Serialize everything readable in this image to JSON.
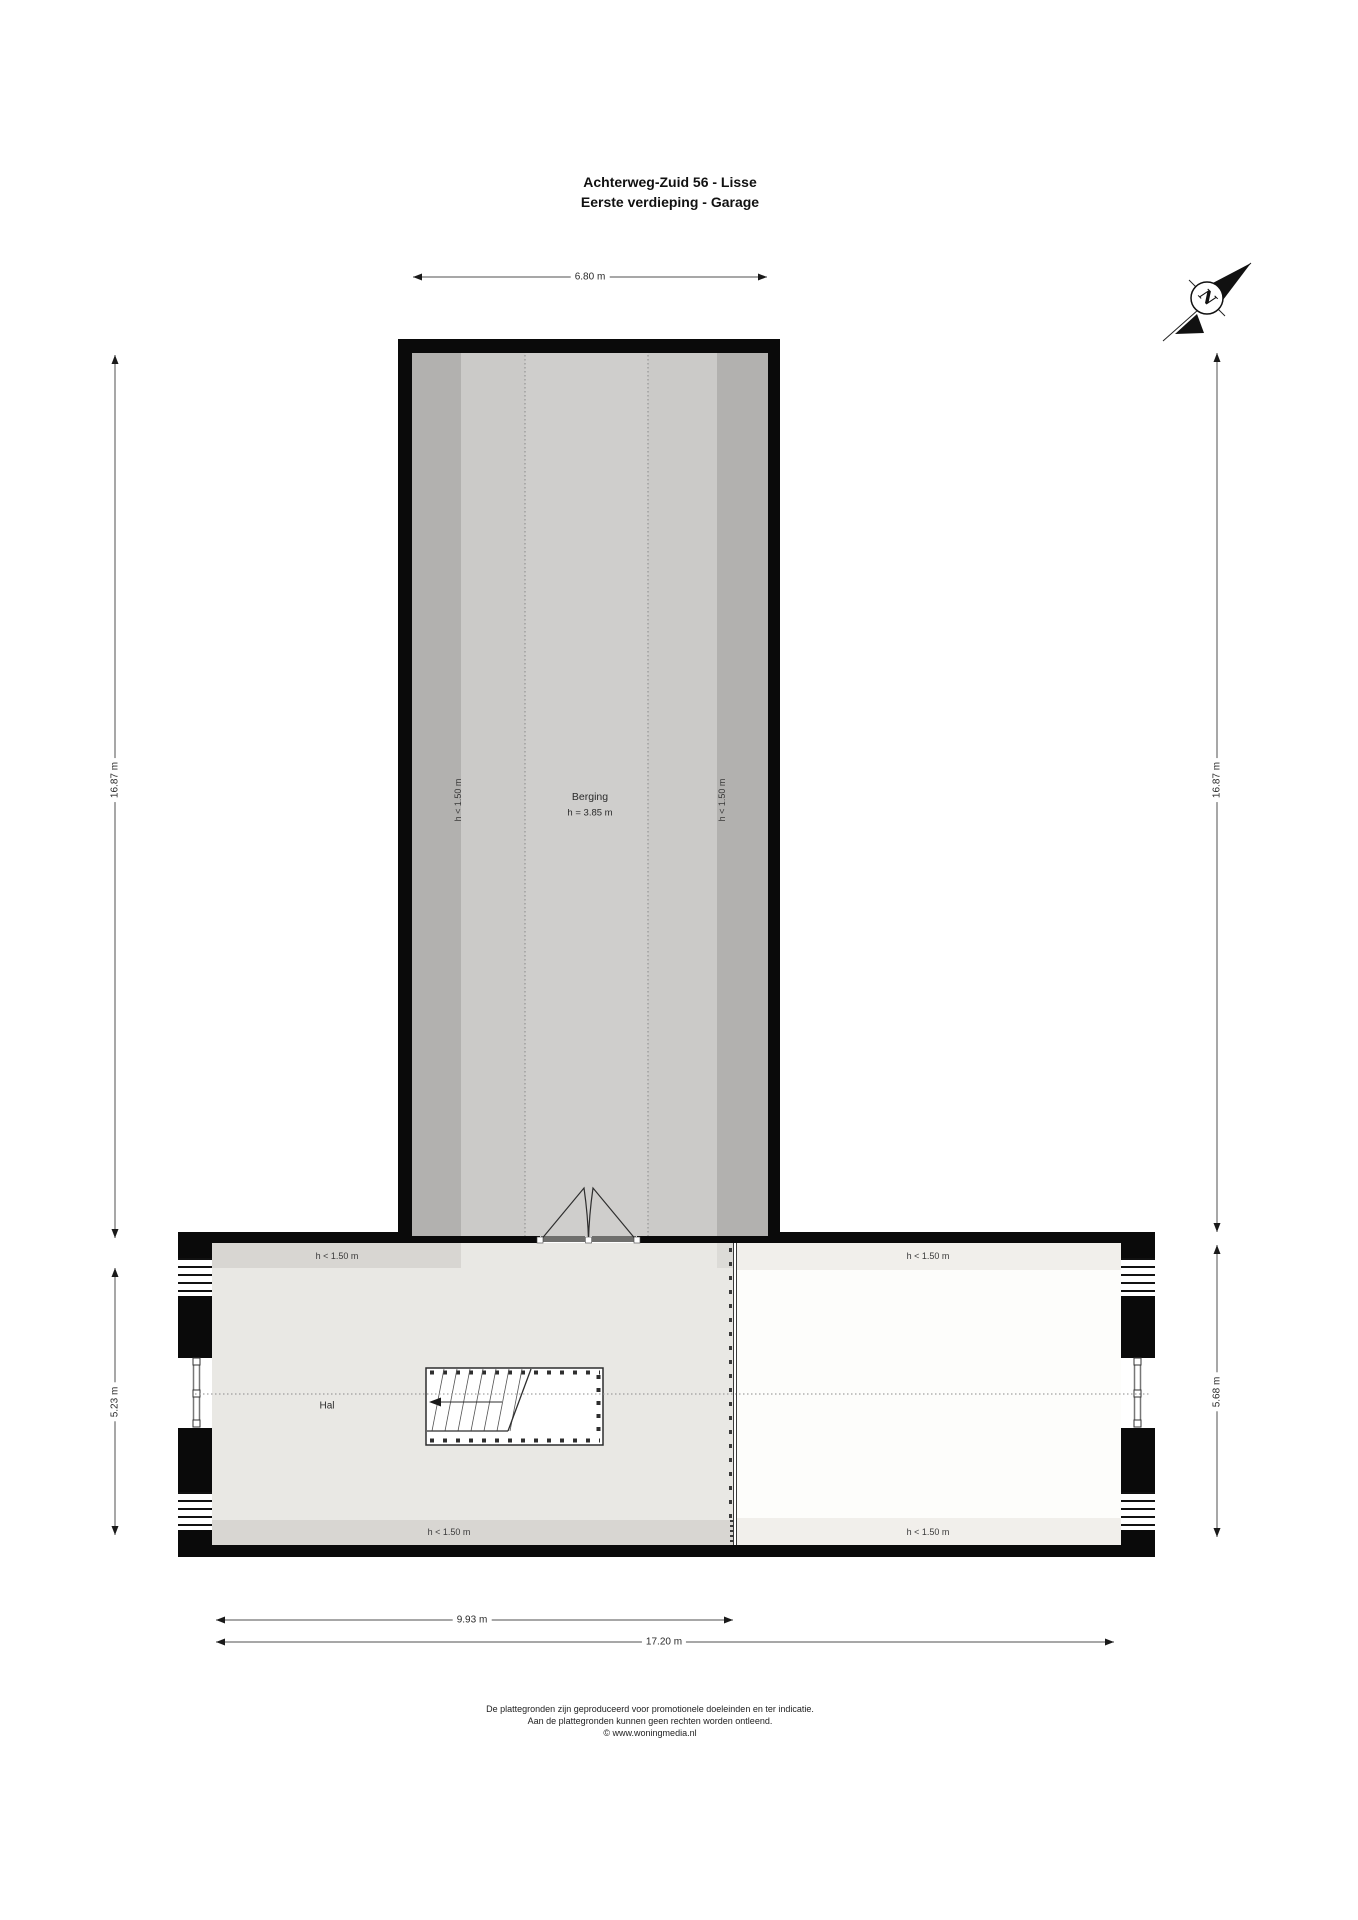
{
  "title": {
    "line1": "Achterweg-Zuid 56 - Lisse",
    "line2": "Eerste verdieping - Garage"
  },
  "compass": {
    "north_label": "N"
  },
  "rooms": {
    "berging": {
      "name": "Berging",
      "ceiling_height": "h = 3.85 m"
    },
    "hal": {
      "name": "Hal"
    }
  },
  "labels": {
    "low_height": "h < 1.50 m"
  },
  "dimensions": {
    "wing_width": "6.80 m",
    "left_total_height": "16.87 m",
    "right_total_height": "16.87 m",
    "bar_left_height": "5.23 m",
    "bar_right_height": "5.68 m",
    "hal_width": "9.93 m",
    "total_width": "17.20 m"
  },
  "footer": {
    "line1": "De plattegronden zijn geproduceerd voor promotionele doeleinden en ter indicatie.",
    "line2": "Aan de plattegronden kunnen geen rechten worden ontleend.",
    "line3": "© www.woningmedia.nl"
  },
  "colors": {
    "wall": "#0a0a0a",
    "wing_low_band": "#b2b1af",
    "wing_floor": "#cbcac8",
    "wing_floor_center": "#cfcecc",
    "hal_floor": "#e9e8e4",
    "hal_low_band": "#d8d6d2",
    "right_floor": "#fdfdfb",
    "right_low_band": "#f1efeb",
    "door_leaf": "#6f6f6d",
    "dimension_line": "#4f4f4f"
  }
}
